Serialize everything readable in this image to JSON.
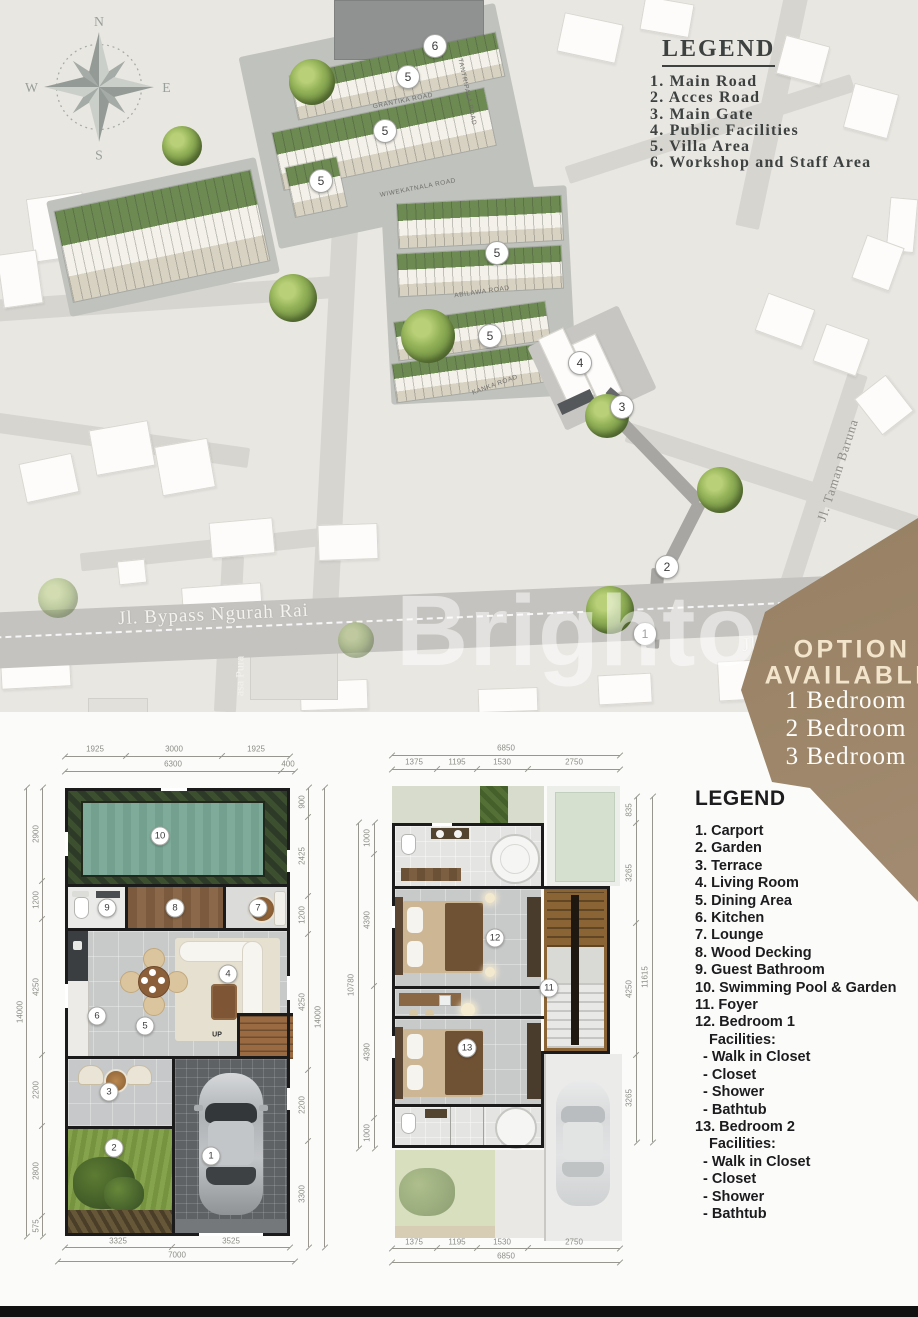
{
  "site": {
    "legend": {
      "title": "LEGEND",
      "items": [
        "1. Main Road",
        "2. Acces Road",
        "3. Main Gate",
        "4. Public Facilities",
        "5. Villa Area",
        "6. Workshop and Staff Area"
      ]
    },
    "compass": {
      "n": "N",
      "e": "E",
      "s": "S",
      "w": "W"
    },
    "markers": [
      "6",
      "5",
      "5",
      "5",
      "5",
      "5",
      "4",
      "3",
      "2",
      "1"
    ],
    "roads": {
      "grantika": "GRANTIKA ROAD",
      "tantripala": "TANTRIPALA ROAD",
      "wiwekatnala": "WIWEKATNALA ROAD",
      "abilawa": "ABILAWA ROAD",
      "kanka": "KANKA ROAD",
      "bypass": "Jl. Bypass Ngurah Rai",
      "bypass_right": "Jl. B",
      "taman_baruna": "Jl. Taman Baruna",
      "angkasa_pura": "asa Pura"
    },
    "watermark": "Brighton"
  },
  "option_panel": {
    "title_line1": "OPTION",
    "title_line2": "AVAILABLE",
    "options": [
      "1 Bedroom",
      "2 Bedroom",
      "3 Bedroom"
    ]
  },
  "floor_legend": {
    "title": "LEGEND",
    "items": [
      "1. Carport",
      "2. Garden",
      "3. Terrace",
      "4. Living Room",
      "5. Dining Area",
      "6. Kitchen",
      "7. Lounge",
      "8. Wood Decking",
      "9. Guest Bathroom",
      "10. Swimming Pool & Garden",
      "11.  Foyer"
    ],
    "bedroom1_label": "12. Bedroom 1",
    "bedroom2_label": "13. Bedroom 2",
    "facilities_label": "Facilities:",
    "facilities": [
      "- Walk in Closet",
      "- Closet",
      "- Shower",
      "- Bathtub"
    ]
  },
  "plan_ground": {
    "up_label": "UP",
    "markers": [
      "1",
      "2",
      "3",
      "4",
      "5",
      "6",
      "7",
      "8",
      "9",
      "10"
    ],
    "dims": {
      "top_row": [
        "1925",
        "3000",
        "1925"
      ],
      "top_row2": [
        "6300",
        "400"
      ],
      "left": [
        "2900",
        "1200",
        "4250",
        "2200",
        "2800",
        "575"
      ],
      "left_total": "14000",
      "right": [
        "900",
        "2425",
        "1200",
        "4250",
        "2200",
        "3300"
      ],
      "right_total": "14000",
      "bottom": [
        "3325",
        "3525"
      ],
      "bottom_total": "7000"
    }
  },
  "plan_upper": {
    "markers": [
      "11",
      "12",
      "13"
    ],
    "dims": {
      "top_total": "6850",
      "top_row": [
        "1375",
        "1195",
        "1530",
        "2750"
      ],
      "left": [
        "1000",
        "4390",
        "4390",
        "1000"
      ],
      "left_total": "10780",
      "right": [
        "835",
        "3265",
        "4250",
        "3265"
      ],
      "right_total": "11615",
      "bottom_row": [
        "1375",
        "1195",
        "1530",
        "2750"
      ],
      "bottom_total": "6850"
    }
  },
  "colors": {
    "accent_brown": "#8e7960",
    "pool_teal": "#7aa593",
    "lawn_green": "#7d9a44",
    "legend_text": "#3d4241",
    "plan_wall": "#1b1b1b",
    "map_bg": "#e9e7e2"
  }
}
